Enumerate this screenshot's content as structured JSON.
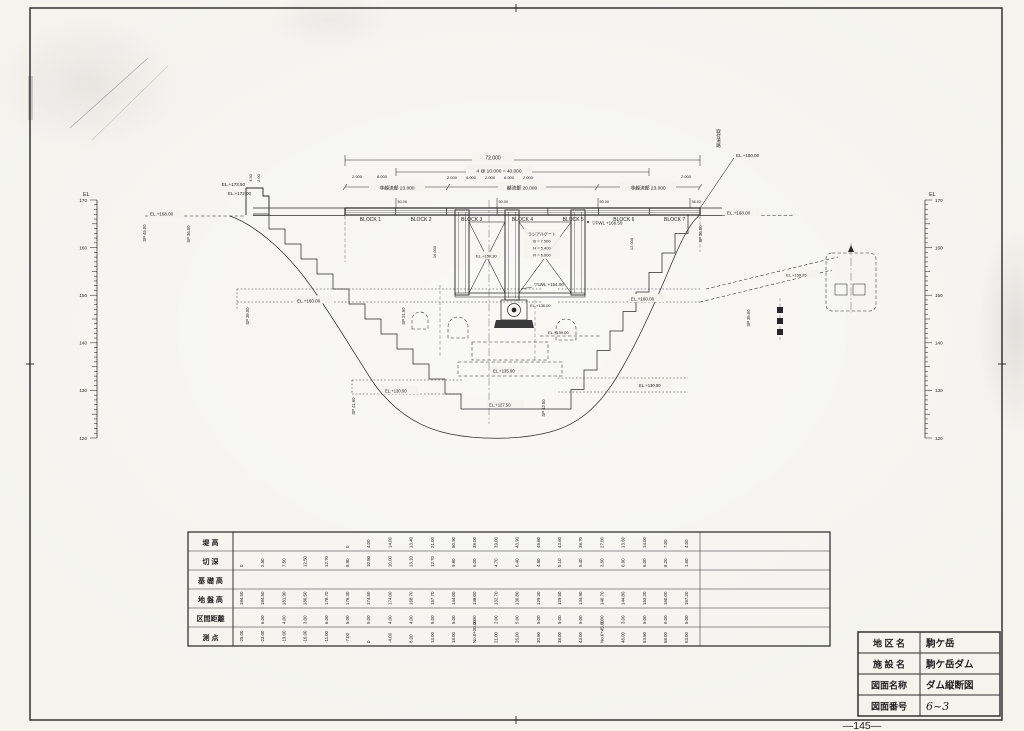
{
  "page": {
    "number": "—145—"
  },
  "scales": {
    "label": "EL",
    "major_ticks": [
      "170",
      "160",
      "150",
      "140",
      "130",
      "120"
    ]
  },
  "dimensions": {
    "total": "72.000",
    "spacing": "4 @ 10.000 = 40.000",
    "left_section": "非越流部 23.000",
    "center_section": "越流部 20.000",
    "right_section": "非越流部 23.000",
    "d1": "2.000",
    "d2": "8.000",
    "d3": "2.000",
    "d4": "6.000",
    "d5": "2.000",
    "d6": "6.000",
    "d7": "2.000",
    "d8": "2.000",
    "pier_height": "16.000",
    "gate_bay": "12.000",
    "parapet_1": "4.50",
    "parapet_2": "2.00"
  },
  "blocks": {
    "labels": [
      "BLOCK 1",
      "BLOCK 2",
      "BLOCK 3",
      "BLOCK 4",
      "BLOCK 5",
      "BLOCK 6",
      "BLOCK 7"
    ]
  },
  "joint_marks": [
    "50.00",
    "50.00",
    "50.00",
    "36.02"
  ],
  "elevations": {
    "el_173_50": "EL.+173.50",
    "el_172_00": "EL.+172.00",
    "el_168_left": "EL.+168.00",
    "el_168_right": "EL.+168.00",
    "el_180": "EL.+180.00",
    "fwl": "▽FWL +166.50",
    "lwl": "▽LWL +154.00",
    "el_159_30": "EL.+159.30",
    "el_136": "EL.+136.00",
    "el_160_left": "EL.+160.00",
    "el_160_right": "EL.+160.00",
    "el_139": "EL.+139.00",
    "el_135": "EL.+135.00",
    "el_130_left": "EL.+130.00",
    "el_130_right": "EL.+130.00",
    "el_127_5": "EL.+127.50",
    "el_159_25": "EL.+159.25"
  },
  "gate": {
    "title": "ラジアルゲート",
    "b": "B = 7.500",
    "h": "H = 5.400",
    "r": "R = 6.000"
  },
  "road_label": "取付道路",
  "sp_labels": [
    "SP 45.00",
    "SP 36.00",
    "SP 39.00",
    "SP 21.50",
    "SP 41.60",
    "SP 43.50",
    "SP 36.00",
    "SP 35.00"
  ],
  "table": {
    "row_labels": [
      "堤  高",
      "切  深",
      "基 礎 高",
      "地 盤 高",
      "区間距離",
      "測  点"
    ],
    "rows": [
      [
        "",
        "",
        "",
        "",
        "",
        "0",
        "4.00",
        "14.00",
        "13.40",
        "21.00",
        "50.90",
        "38.00",
        "39.00",
        "43.90",
        "45.60",
        "43.60",
        "38.70",
        "27.00",
        "13.60",
        "14.00",
        "7.00",
        "4.00"
      ],
      [
        "0",
        "2.50",
        "7.50",
        "12.50",
        "12.70",
        "8.90",
        "10.50",
        "10.00",
        "13.10",
        "12.70",
        "9.80",
        "6.00",
        "4.70",
        "6.40",
        "4.90",
        "5.10",
        "5.40",
        "3.60",
        "6.90",
        "6.00",
        "8.20",
        "1.60"
      ],
      [],
      [
        "184.50",
        "184.50",
        "181.90",
        "180.50",
        "178.70",
        "176.30",
        "174.50",
        "174.00",
        "168.70",
        "157.70",
        "144.00",
        "138.00",
        "132.70",
        "130.80",
        "129.30",
        "129.50",
        "134.90",
        "140.70",
        "144.80",
        "153.20",
        "160.00",
        "167.20"
      ],
      [
        "",
        "6.00",
        "4.00",
        "3.00",
        "6.00",
        "5.00",
        "5.00",
        "4.00",
        "4.00",
        "5.00",
        "5.00",
        "3.00",
        "2.00",
        "5.00",
        "5.00",
        "5.00",
        "5.00",
        "2.00",
        "3.00",
        "5.00",
        "6.00",
        "5.00"
      ],
      [
        "-25.00",
        "-23.00",
        "-19.00",
        "-16.00",
        "-11.00",
        "-7.00",
        "0",
        "-4.00",
        "8.00",
        "13.00",
        "18.00",
        "No.0+20.00",
        "21.00",
        "26.00",
        "30.50",
        "38.00",
        "43.00",
        "No.0+45.00",
        "48.00",
        "53.50",
        "58.00",
        "63.00"
      ]
    ]
  },
  "title_block": {
    "rows": [
      {
        "label": "地 区 名",
        "value": "駒ケ岳"
      },
      {
        "label": "施 設 名",
        "value": "駒ケ岳ダム"
      },
      {
        "label": "図面名称",
        "value": "ダム縦断図"
      },
      {
        "label": "図面番号",
        "value": "6~3"
      }
    ]
  }
}
